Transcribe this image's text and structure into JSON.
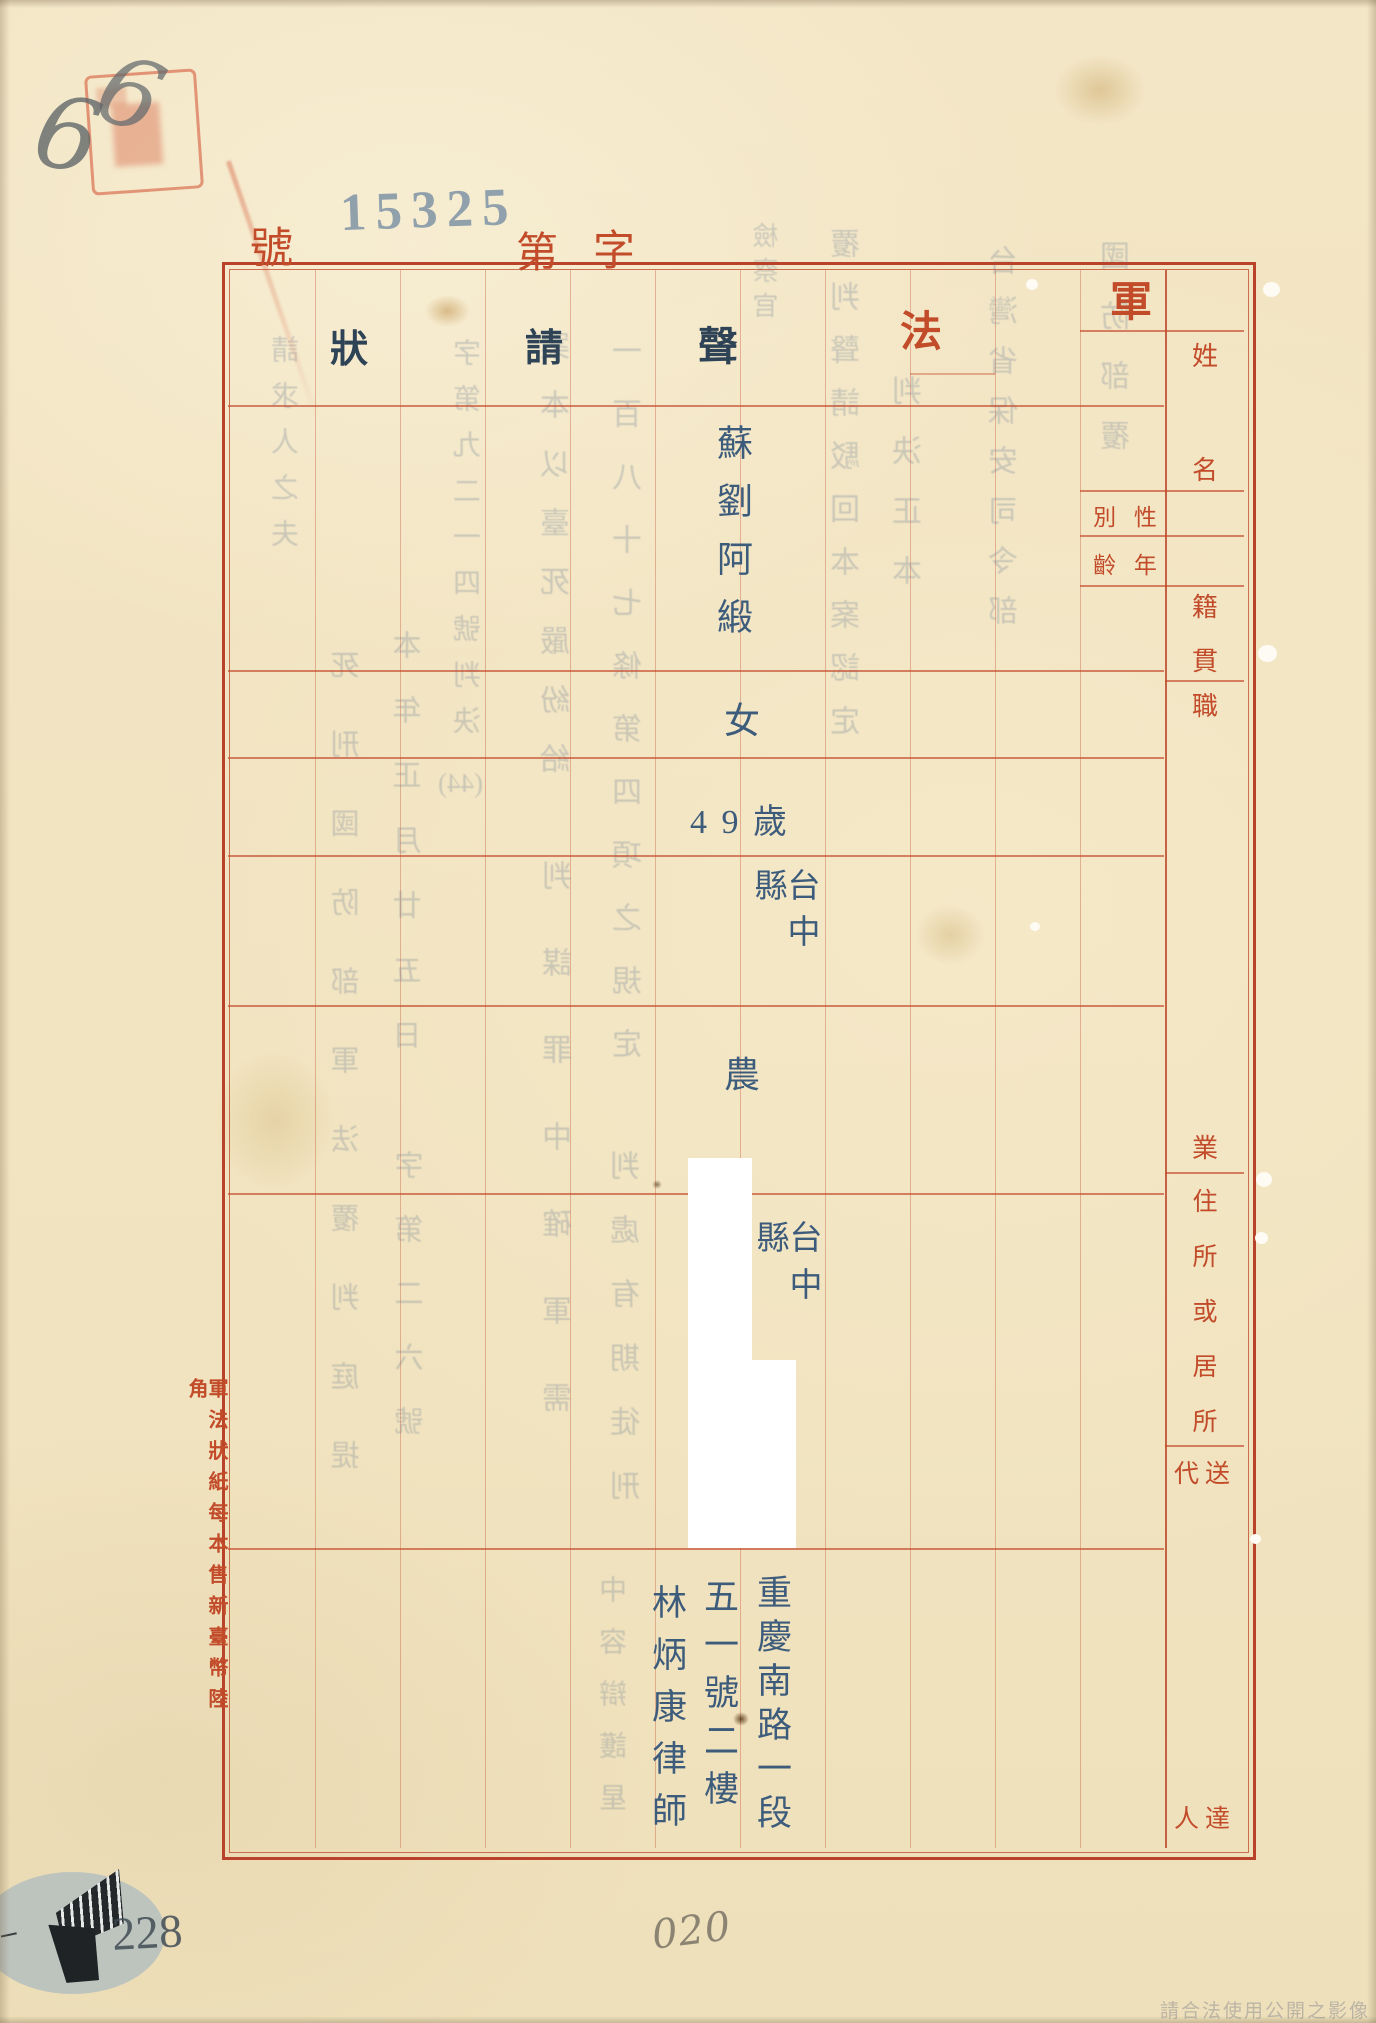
{
  "document": {
    "serial": {
      "no_label": "號",
      "number": "15325",
      "dai_label": "第",
      "zi_label": "字"
    },
    "form_title_printed": [
      "軍",
      "法"
    ],
    "form_title_typed": [
      "聲",
      "請",
      "狀"
    ],
    "margin_note": "軍法狀紙每本售新臺幣陸角",
    "watermark": "請合法使用公開之影像"
  },
  "headers": {
    "name": {
      "label": "姓名",
      "chars": [
        "姓",
        "名"
      ]
    },
    "sex": {
      "label": "性別",
      "display": "別 性"
    },
    "age": {
      "label": "年齡",
      "display": "齡 年"
    },
    "native": {
      "label": "籍貫",
      "chars": [
        "籍",
        "貫"
      ]
    },
    "occupation": {
      "label": "職業",
      "chars": [
        "職",
        "業"
      ]
    },
    "residence": {
      "label": "住所或居所",
      "chars": [
        "住",
        "所",
        "或",
        "居",
        "所"
      ]
    },
    "agent": {
      "label": "送達代人",
      "row_top": "代送",
      "row_bottom": "人達"
    }
  },
  "values": {
    "name": "蘇劉阿緞",
    "sex": "女",
    "age": "4 9 歲",
    "native": "台中縣",
    "occupation": "農",
    "residence_visible": "台中縣",
    "agent_address_line1": "重慶南路一段",
    "agent_address_line2": "五一號二樓",
    "agent_name": "林炳康律師"
  },
  "annotations": {
    "pencil_digit_a": "6",
    "pencil_digit_b": "6",
    "archive_number": "228",
    "handwritten_number": "020"
  },
  "bleedthrough": {
    "cols": [
      {
        "text": "國防部覆"
      },
      {
        "text": "台灣省保安司令部"
      },
      {
        "text": "判決正本"
      },
      {
        "text": "覆判聲請駁回本案認定"
      },
      {
        "text": "檢察官"
      },
      {
        "text": "一百八十七條第四項之規定"
      },
      {
        "text": "判處有期徒刑"
      },
      {
        "text": "案本以臺死嚴紛給"
      },
      {
        "text": "判謀罪中確軍需"
      },
      {
        "text": "字第九二一四號判決"
      },
      {
        "text": "(44)"
      },
      {
        "text": "本年正月廿五日"
      },
      {
        "text": "字第二六號"
      },
      {
        "text": "死刑國防部軍法覆判庭提"
      },
      {
        "text": "請求人之夫"
      },
      {
        "text": "中容辯護星"
      }
    ]
  }
}
